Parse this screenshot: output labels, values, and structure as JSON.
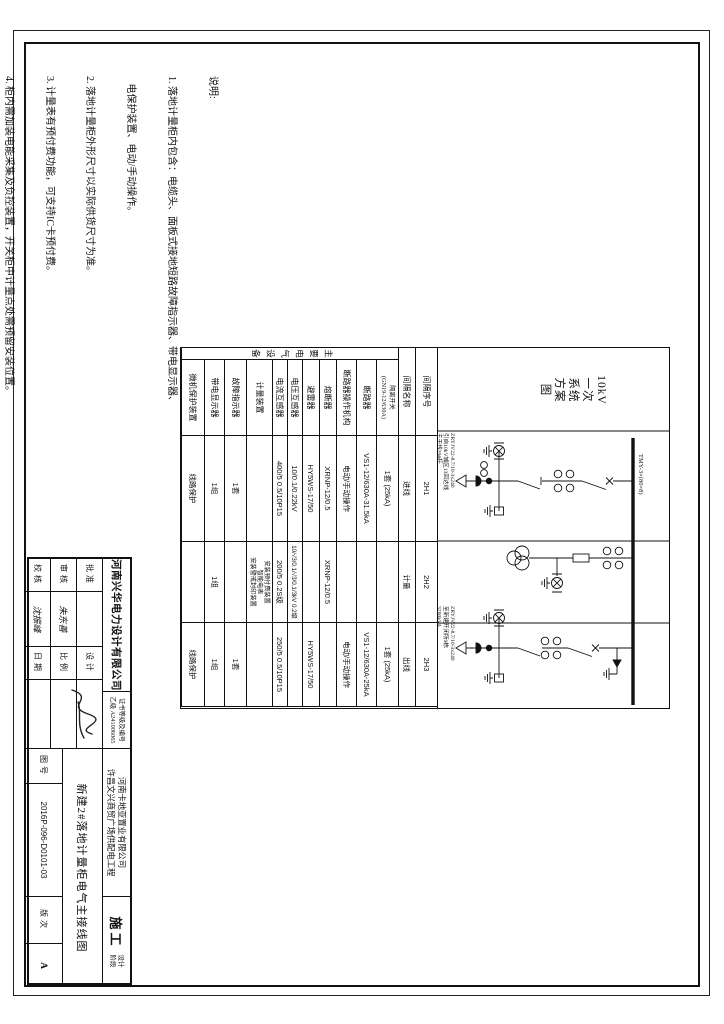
{
  "notes": {
    "title": "说明:",
    "lines": [
      "1. 落地计量柜内包含：电缆头、面板式接地短路故障指示器、带电显示器、",
      "   电保护装置、电动/手动操作。",
      "2. 落地计量柜外形尺寸以实际供货尺寸为准。",
      "3. 计量表有预付费功能，可支持IC卡预付费。",
      "4. 柜内需加装电能采集及负控装置，开关柜中计量点处需预留安装位置。",
      "5. 计量柜单独加装明锁，表计不需要观察孔，计量二次线（电压线、电流线）",
      "6. 进线柜加装电缆头。",
      "7. 落地计量柜落地安装，距地面不低于500mm。",
      "8. 落地计量柜柜体四周应设置带电危险、请勿靠近等警示标语。"
    ]
  },
  "scheme_title": [
    "10kV",
    "一次",
    "系统",
    "方案",
    "图"
  ],
  "schematic": {
    "busbar_label": "TMY-3×(80×8)",
    "bay1_annotation": [
      "ZRYJV22-8.7/10-3x240",
      "引自10kV城区13回达线",
      "主干线39#杆"
    ],
    "bay3_annotation": [
      "ZRYJV22-8.7/10-3x240",
      "至新建开闭所9栋",
      "3200kVA"
    ]
  },
  "table": {
    "group_header": "主要电气设备",
    "rows": [
      {
        "label": "间隔序号",
        "values": [
          "2H1",
          "2H2",
          "2H3"
        ]
      },
      {
        "label": "间隔名称",
        "values": [
          "进线",
          "计量",
          "出线"
        ]
      },
      {
        "label": "隔离开关\n(GN19-12/630A)",
        "values": [
          "1套 (25kA)",
          "",
          "1套 (25kA)"
        ]
      },
      {
        "label": "断路器",
        "values": [
          "VS1-12/630A-31.5kA",
          "",
          "VS1-12/630A-25kA"
        ]
      },
      {
        "label": "断路器操作机构",
        "values": [
          "电动/手动操作",
          "",
          "电动/手动操作"
        ]
      },
      {
        "label": "熔断器",
        "values": [
          "XRNP-12/0.5",
          "XRNP-12/0.5",
          ""
        ]
      },
      {
        "label": "避雷器",
        "values": [
          "HY5WS-17/50",
          "",
          "HY5WS-17/50"
        ]
      },
      {
        "label": "电压互感器",
        "values": [
          "10/0.1/0.22kV",
          "10/√3/0.1/√3/0.1/3kV 0.2级",
          ""
        ]
      },
      {
        "label": "电流互感器",
        "values": [
          "400/5  0.5/10P15",
          "200/5  0.2S级",
          "250/5  0.5/10P15"
        ]
      },
      {
        "label": "计量装置",
        "values": [
          "",
          "安装预付费装置\n智能电表\n安装警戒封印装置",
          ""
        ]
      },
      {
        "label": "故障指示器",
        "values": [
          "1套",
          "",
          "1套"
        ]
      },
      {
        "label": "带电显示器",
        "values": [
          "1组",
          "1组",
          "1组"
        ]
      },
      {
        "label": "微机保护装置",
        "values": [
          "线路保护",
          "",
          "线路保护"
        ]
      }
    ]
  },
  "title_block": {
    "design_company": "河南兴华电力设计有限公司",
    "cert_label": "证书等级及编号",
    "cert_value": "乙级 A241006065",
    "client_company": "河南卡地亚置业有限公司",
    "project_name": "许昌文兴商贸广场供配电工程",
    "drawing_title": "新建2#落地计量柜电气主接线图",
    "stage_value": "施工",
    "stage_label": "设计\n阶段",
    "approve_label": "批准",
    "approve_value": "",
    "review_label": "审核",
    "review_value": "朱东善",
    "check_label": "校核",
    "check_value": "沈振峰",
    "design_label": "设计",
    "scale_label": "比例",
    "scale_value": "",
    "date_label": "日期",
    "date_value": "",
    "dwg_no_label": "图号",
    "dwg_no_value": "2016P-096-D0101-03",
    "rev_label": "版次",
    "rev_value": "A"
  }
}
